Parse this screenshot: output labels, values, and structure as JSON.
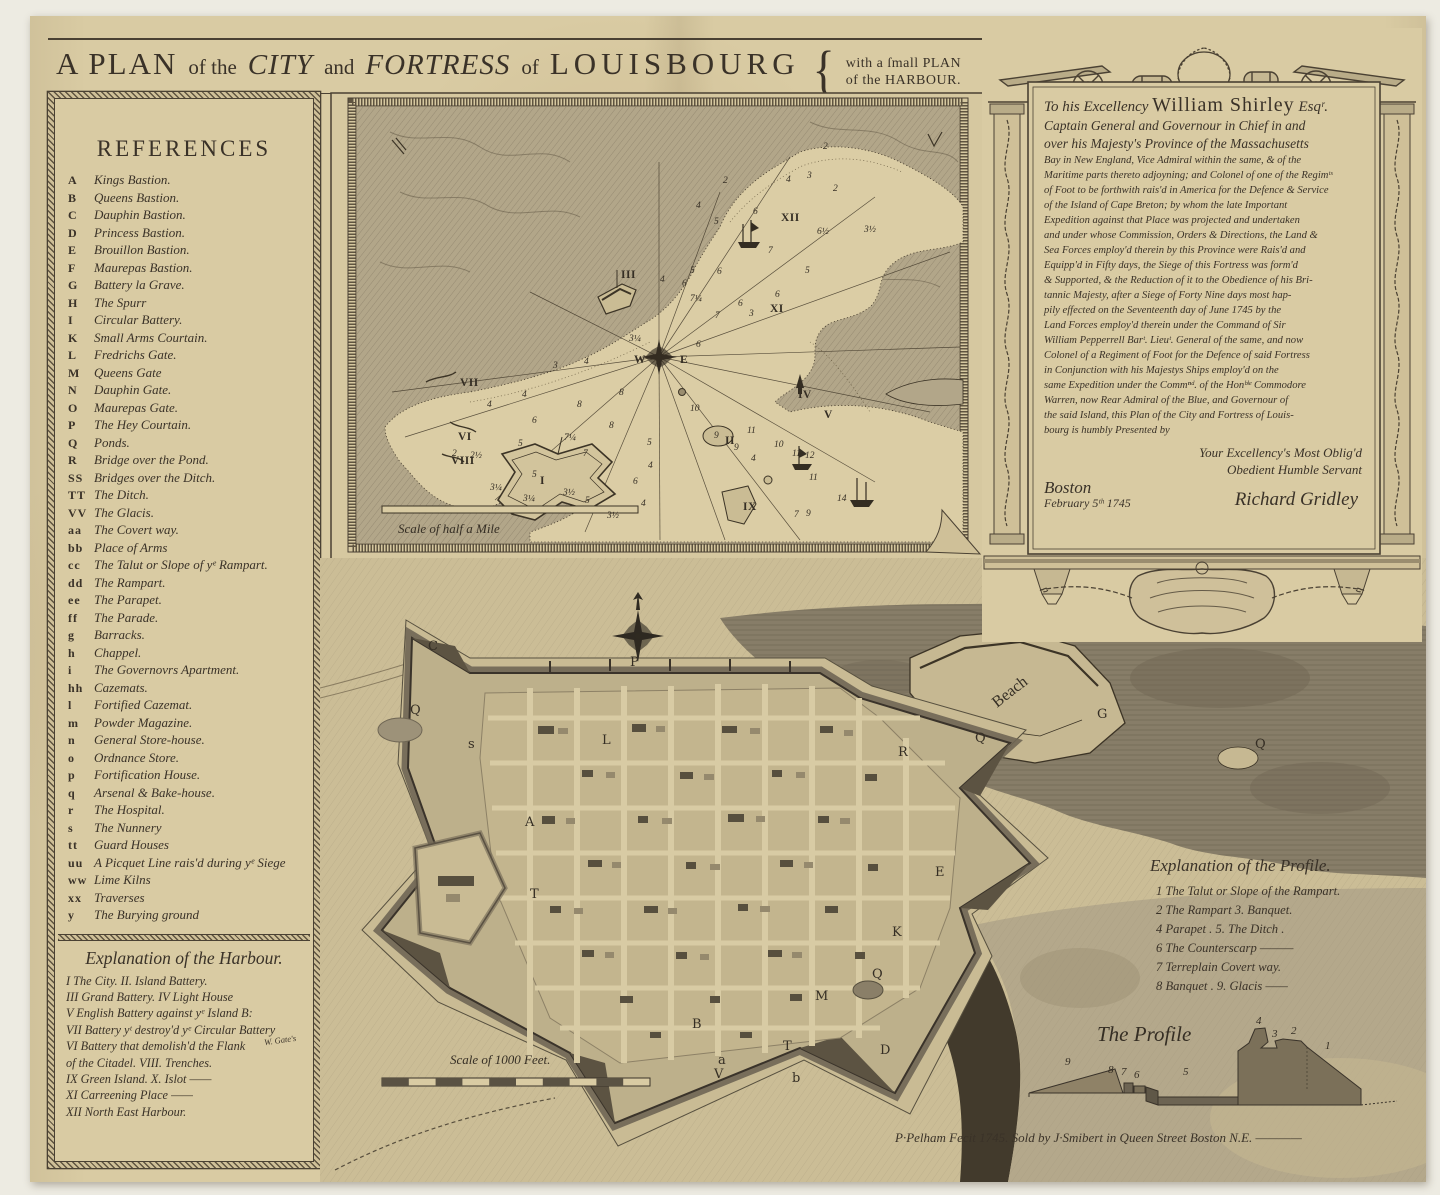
{
  "title": {
    "segments": [
      {
        "t": "A PLAN"
      },
      {
        "t": "of the"
      },
      {
        "t": "CITY"
      },
      {
        "t": "and"
      },
      {
        "t": "FORTRESS"
      },
      {
        "t": "of"
      },
      {
        "t": "LOUISBOURG"
      }
    ],
    "brace": "{",
    "note_line1": "with a ſmall PLAN",
    "note_line2": "of the HARBOUR."
  },
  "references": {
    "heading": "REFERENCES",
    "items": [
      {
        "key": "A",
        "label": "Kings Bastion."
      },
      {
        "key": "B",
        "label": "Queens Bastion."
      },
      {
        "key": "C",
        "label": "Dauphin Bastion."
      },
      {
        "key": "D",
        "label": "Princess Bastion."
      },
      {
        "key": "E",
        "label": "Brouillon Bastion."
      },
      {
        "key": "F",
        "label": "Maurepas Bastion."
      },
      {
        "key": "G",
        "label": "Battery la Grave."
      },
      {
        "key": "H",
        "label": "The Spurr"
      },
      {
        "key": "I",
        "label": "Circular Battery."
      },
      {
        "key": "K",
        "label": "Small Arms Courtain."
      },
      {
        "key": "L",
        "label": "Fredrichs Gate."
      },
      {
        "key": "M",
        "label": "Queens Gate"
      },
      {
        "key": "N",
        "label": "Dauphin Gate."
      },
      {
        "key": "O",
        "label": "Maurepas Gate."
      },
      {
        "key": "P",
        "label": "The Hey Courtain."
      },
      {
        "key": "Q",
        "label": "Ponds."
      },
      {
        "key": "R",
        "label": "Bridge over the Pond."
      },
      {
        "key": "SS",
        "label": "Bridges over the Ditch."
      },
      {
        "key": "TT",
        "label": "The Ditch."
      },
      {
        "key": "VV",
        "label": "The Glacis."
      },
      {
        "key": "aa",
        "label": "The Covert way."
      },
      {
        "key": "bb",
        "label": "Place of Arms"
      },
      {
        "key": "cc",
        "label": "The Talut or Slope of yᵉ Rampart."
      },
      {
        "key": "dd",
        "label": "The Rampart."
      },
      {
        "key": "ee",
        "label": "The Parapet."
      },
      {
        "key": "ff",
        "label": "The Parade."
      },
      {
        "key": "g",
        "label": "Barracks."
      },
      {
        "key": "h",
        "label": "Chappel."
      },
      {
        "key": "i",
        "label": "The Governovrs Apartment."
      },
      {
        "key": "hh",
        "label": "Cazemats."
      },
      {
        "key": "l",
        "label": "Fortified Cazemat."
      },
      {
        "key": "m",
        "label": "Powder Magazine."
      },
      {
        "key": "n",
        "label": "General Store-house."
      },
      {
        "key": "o",
        "label": "Ordnance Store."
      },
      {
        "key": "p",
        "label": "Fortification House."
      },
      {
        "key": "q",
        "label": "Arsenal & Bake-house."
      },
      {
        "key": "r",
        "label": "The Hospital."
      },
      {
        "key": "s",
        "label": "The Nunnery"
      },
      {
        "key": "tt",
        "label": "Guard Houses"
      },
      {
        "key": "uu",
        "label": "A Picquet Line rais'd during yᵉ Siege"
      },
      {
        "key": "ww",
        "label": "Lime Kilns"
      },
      {
        "key": "xx",
        "label": "Traverses"
      },
      {
        "key": "y",
        "label": "The Burying ground"
      }
    ]
  },
  "harbour_explanation": {
    "heading": "Explanation of the Harbour.",
    "insert": "W. Gate's",
    "lines": [
      "I The City. II. Island Battery.",
      "III Grand Battery. IV Light House",
      "V English Battery against yᵉ Island B:",
      "VII Battery yᵗ destroy'd yᵉ Circular Battery",
      "VI Battery that demolish'd the Flank",
      "of the Citadel. VIII. Trenches.",
      "IX Green Island. X. Islot ——",
      "XI Carreening Place ——",
      "XII North East Harbour."
    ]
  },
  "dedication": {
    "salutation_script": "To his Excellency",
    "salutation_name": "William Shirley",
    "salutation_esq": "Esqʳ.",
    "body_lines": [
      "Captain General and Governour in Chief in and",
      "over his Majesty's Province of the Massachusetts",
      "Bay in New England, Vice Admiral within the same, & of the",
      "Maritime parts thereto adjoyning; and Colonel of one of the Regimᵗˢ",
      "of Foot to be forthwith rais'd in America for the Defence & Service",
      "of the Island of Cape Breton; by whom the late Important",
      "Expedition against that Place was projected and undertaken",
      "and under whose Commission, Orders & Directions, the Land &",
      "Sea Forces employ'd therein by this Province were Rais'd and",
      "Equipp'd in Fifty days, the Siege of this Fortress was form'd",
      "& Supported, & the Reduction of it to the Obedience of his Bri-",
      "tannic Majesty, after a Siege of Forty Nine days most hap-",
      "pily effected on the Seventeenth day of June 1745 by the",
      "Land Forces employ'd therein under the Command of Sir",
      "William Pepperrell Barᵗ. Lieuᵗ. General of the same, and now",
      "Colonel of a Regiment of Foot for the Defence of said Fortress",
      "in Conjunction with his Majestys Ships employ'd on the",
      "same Expedition under the Commⁿᵈ. of the Honᵇˡᵉ Commodore",
      "Warren, now Rear Admiral of the Blue, and Governour of",
      "the said Island, this Plan of the City and Fortress of Louis-",
      "bourg is humbly Presented by"
    ],
    "closing_line1": "Your Excellency's Most Oblig'd",
    "closing_line2": "Obedient Humble Servant",
    "place": "Boston",
    "date": "February 5ᵗʰ 1745",
    "signature": "Richard Gridley"
  },
  "inset": {
    "scale_label": "Scale of half a Mile",
    "numerals": [
      {
        "t": "I",
        "x": 210,
        "y": 392
      },
      {
        "t": "II",
        "x": 395,
        "y": 352
      },
      {
        "t": "III",
        "x": 291,
        "y": 186
      },
      {
        "t": "IV",
        "x": 468,
        "y": 306
      },
      {
        "t": "V",
        "x": 494,
        "y": 326
      },
      {
        "t": "VI",
        "x": 128,
        "y": 348
      },
      {
        "t": "VII",
        "x": 130,
        "y": 294
      },
      {
        "t": "VIII",
        "x": 121,
        "y": 372
      },
      {
        "t": "IX",
        "x": 413,
        "y": 418
      },
      {
        "t": "XI",
        "x": 440,
        "y": 220
      },
      {
        "t": "XII",
        "x": 451,
        "y": 129
      },
      {
        "t": "W",
        "x": 304,
        "y": 271
      },
      {
        "t": "E",
        "x": 350,
        "y": 271
      }
    ],
    "soundings": [
      {
        "t": "2",
        "x": 393,
        "y": 91
      },
      {
        "t": "4",
        "x": 366,
        "y": 116
      },
      {
        "t": "5",
        "x": 384,
        "y": 132
      },
      {
        "t": "6",
        "x": 423,
        "y": 122
      },
      {
        "t": "4",
        "x": 456,
        "y": 90
      },
      {
        "t": "3",
        "x": 477,
        "y": 86
      },
      {
        "t": "2",
        "x": 493,
        "y": 57
      },
      {
        "t": "2",
        "x": 503,
        "y": 99
      },
      {
        "t": "6½",
        "x": 487,
        "y": 142
      },
      {
        "t": "3½",
        "x": 534,
        "y": 140
      },
      {
        "t": "5",
        "x": 475,
        "y": 181
      },
      {
        "t": "6",
        "x": 445,
        "y": 205
      },
      {
        "t": "6",
        "x": 408,
        "y": 214
      },
      {
        "t": "3",
        "x": 419,
        "y": 224
      },
      {
        "t": "7",
        "x": 385,
        "y": 226
      },
      {
        "t": "6",
        "x": 352,
        "y": 194
      },
      {
        "t": "7¼",
        "x": 360,
        "y": 209
      },
      {
        "t": "4",
        "x": 330,
        "y": 190
      },
      {
        "t": "5",
        "x": 360,
        "y": 181
      },
      {
        "t": "6",
        "x": 387,
        "y": 182
      },
      {
        "t": "7",
        "x": 438,
        "y": 161
      },
      {
        "t": "6",
        "x": 366,
        "y": 255
      },
      {
        "t": "3¼",
        "x": 299,
        "y": 249
      },
      {
        "t": "3",
        "x": 223,
        "y": 276
      },
      {
        "t": "4",
        "x": 254,
        "y": 272
      },
      {
        "t": "4",
        "x": 192,
        "y": 305
      },
      {
        "t": "4",
        "x": 157,
        "y": 315
      },
      {
        "t": "6",
        "x": 202,
        "y": 331
      },
      {
        "t": "8",
        "x": 247,
        "y": 315
      },
      {
        "t": "8",
        "x": 279,
        "y": 336
      },
      {
        "t": "8",
        "x": 289,
        "y": 303
      },
      {
        "t": "5",
        "x": 188,
        "y": 354
      },
      {
        "t": "7¼",
        "x": 234,
        "y": 348
      },
      {
        "t": "7",
        "x": 253,
        "y": 364
      },
      {
        "t": "2½",
        "x": 140,
        "y": 366
      },
      {
        "t": "2",
        "x": 122,
        "y": 364
      },
      {
        "t": "5",
        "x": 202,
        "y": 385
      },
      {
        "t": "3¼",
        "x": 160,
        "y": 398
      },
      {
        "t": "3¼",
        "x": 193,
        "y": 409
      },
      {
        "t": "3½",
        "x": 233,
        "y": 403
      },
      {
        "t": "5",
        "x": 255,
        "y": 411
      },
      {
        "t": "3½",
        "x": 277,
        "y": 426
      },
      {
        "t": "5",
        "x": 317,
        "y": 353
      },
      {
        "t": "4",
        "x": 318,
        "y": 376
      },
      {
        "t": "6",
        "x": 303,
        "y": 392
      },
      {
        "t": "4",
        "x": 311,
        "y": 414
      },
      {
        "t": "10",
        "x": 360,
        "y": 319
      },
      {
        "t": "9",
        "x": 384,
        "y": 346
      },
      {
        "t": "9",
        "x": 404,
        "y": 358
      },
      {
        "t": "4",
        "x": 421,
        "y": 369
      },
      {
        "t": "11",
        "x": 417,
        "y": 341
      },
      {
        "t": "10",
        "x": 444,
        "y": 355
      },
      {
        "t": "11",
        "x": 462,
        "y": 364
      },
      {
        "t": "12",
        "x": 475,
        "y": 366
      },
      {
        "t": "11",
        "x": 479,
        "y": 388
      },
      {
        "t": "14",
        "x": 507,
        "y": 409
      },
      {
        "t": "7",
        "x": 464,
        "y": 425
      },
      {
        "t": "9",
        "x": 476,
        "y": 424
      }
    ],
    "labels": [
      {
        "t": "Scale of half a Mile",
        "x": 68,
        "y": 441,
        "cls": "scr13"
      }
    ]
  },
  "main_map": {
    "scale_label": "Scale of 1000 Feet.",
    "letters": [
      {
        "t": "C",
        "x": 108,
        "y": 92
      },
      {
        "t": "P",
        "x": 310,
        "y": 108
      },
      {
        "t": "L",
        "x": 282,
        "y": 186
      },
      {
        "t": "Q",
        "x": 90,
        "y": 156
      },
      {
        "t": "s",
        "x": 148,
        "y": 190
      },
      {
        "t": "A",
        "x": 205,
        "y": 268
      },
      {
        "t": "T",
        "x": 210,
        "y": 340
      },
      {
        "t": "G",
        "x": 777,
        "y": 160
      },
      {
        "t": "R",
        "x": 578,
        "y": 198
      },
      {
        "t": "Q",
        "x": 655,
        "y": 184
      },
      {
        "t": "Q",
        "x": 935,
        "y": 190
      },
      {
        "t": "E",
        "x": 615,
        "y": 318
      },
      {
        "t": "K",
        "x": 572,
        "y": 378
      },
      {
        "t": "M",
        "x": 495,
        "y": 442
      },
      {
        "t": "B",
        "x": 372,
        "y": 470
      },
      {
        "t": "T",
        "x": 463,
        "y": 492
      },
      {
        "t": "V",
        "x": 394,
        "y": 520
      },
      {
        "t": "D",
        "x": 560,
        "y": 496
      },
      {
        "t": "b",
        "x": 472,
        "y": 524
      },
      {
        "t": "a",
        "x": 398,
        "y": 506
      },
      {
        "t": "Q",
        "x": 552,
        "y": 420
      }
    ],
    "labels": [
      {
        "t": "Beach",
        "x": 677,
        "y": 150,
        "rot": -38,
        "cls": "lbl"
      },
      {
        "t": "Scale of 1000 Feet.",
        "x": 130,
        "y": 506,
        "cls": "scr13"
      }
    ]
  },
  "profile_explanation": {
    "heading": "Explanation of the Profile.",
    "lines": [
      "1   The Talut or Slope of the Rampart.",
      "2   The Rampart  3. Banquet.",
      "4   Parapet . 5. The Ditch .",
      "6   The Counterscarp ———",
      "7   Terreplain Covert way.",
      "8   Banquet . 9. Glacis ——"
    ]
  },
  "profile_figure": {
    "title": "The Profile",
    "numbers": [
      {
        "t": "9",
        "x": 40,
        "y": 50
      },
      {
        "t": "8",
        "x": 83,
        "y": 58
      },
      {
        "t": "7",
        "x": 96,
        "y": 60
      },
      {
        "t": "6",
        "x": 109,
        "y": 63
      },
      {
        "t": "5",
        "x": 158,
        "y": 60
      },
      {
        "t": "4",
        "x": 231,
        "y": 9
      },
      {
        "t": "3",
        "x": 247,
        "y": 22
      },
      {
        "t": "2",
        "x": 266,
        "y": 19
      },
      {
        "t": "1",
        "x": 300,
        "y": 34
      }
    ]
  },
  "imprint": "P·Pelham Fecit 1745. Sold by J·Smibert in Queen Street Boston N.E. ————"
}
